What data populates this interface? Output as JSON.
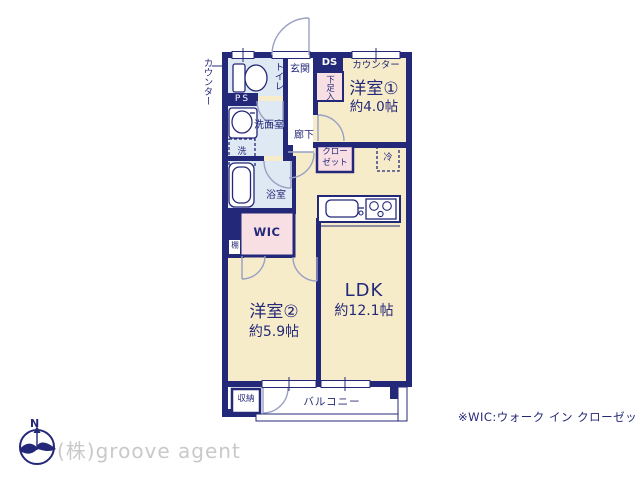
{
  "colors": {
    "wall_navy": "#242878",
    "room_cream": "#f6ecca",
    "wet_blue": "#dfe9f3",
    "closet_pink": "#f8dfe4",
    "door_arc": "#99a0c4",
    "company_gray": "#c9c9c9"
  },
  "labels": {
    "counter_left": "カウンター",
    "toilet": "トイレ",
    "entrance": "玄関",
    "ds": "DS",
    "shoe_box": "下足入",
    "counter_top": "カウンター",
    "room1": "洋室①",
    "room1_size": "約4.0帖",
    "ps": "PS",
    "washroom": "洗面室",
    "hallway": "廊下",
    "washer": "洗",
    "bath": "浴室",
    "closet_line1": "クロー",
    "closet_line2": "ゼット",
    "fridge": "冷",
    "wic": "WIC",
    "shelf": "棚",
    "ldk": "LDK",
    "ldk_size": "約12.1帖",
    "room2": "洋室②",
    "room2_size": "約5.9帖",
    "storage": "収納",
    "balcony": "バルコニー"
  },
  "footer": {
    "note": "※WIC:ウォーク イン クローゼット",
    "company": "(株)groove agent",
    "compass_n": "N"
  }
}
